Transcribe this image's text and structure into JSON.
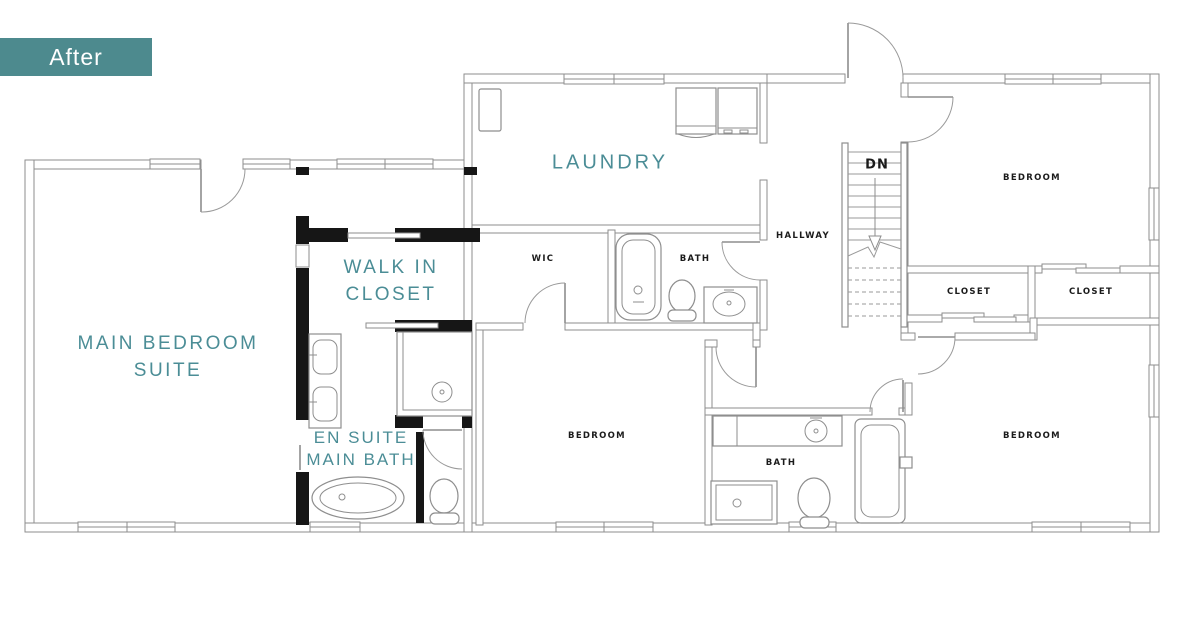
{
  "badge": {
    "label": "After"
  },
  "colors": {
    "badge_bg": "#4d8a8e",
    "teal_label": "#4b8d96",
    "black_label": "#1b1b1b",
    "existing_wall": "#8e8e8e",
    "new_wall": "#161616"
  },
  "rooms": {
    "main_suite": {
      "line1": "MAIN BEDROOM",
      "line2": "SUITE"
    },
    "walk_in": {
      "line1": "WALK IN",
      "line2": "CLOSET"
    },
    "ensuite": {
      "line1": "EN SUITE",
      "line2": "MAIN BATH"
    },
    "laundry": {
      "label": "LAUNDRY"
    },
    "wic": {
      "label": "WIC"
    },
    "bath_top": {
      "label": "BATH"
    },
    "hallway": {
      "label": "HALLWAY"
    },
    "bedroom_top_right": {
      "label": "BEDROOM"
    },
    "closet_left": {
      "label": "CLOSET"
    },
    "closet_right": {
      "label": "CLOSET"
    },
    "bedroom_bottom_middle": {
      "label": "BEDROOM"
    },
    "bedroom_bottom_right": {
      "label": "BEDROOM"
    },
    "bath_bottom": {
      "label": "BATH"
    }
  },
  "stairs": {
    "direction_label": "DN"
  },
  "fixtures": [
    "washer",
    "dryer",
    "tall-cabinet",
    "bathtub-top-bath",
    "toilet-top-bath",
    "vanity-top-bath",
    "double-vanity-ensuite",
    "walk-in-shower-ensuite",
    "freestanding-tub",
    "toilet-ensuite",
    "vanity-bottom-bath",
    "toilet-bottom-bath",
    "bathtub-bottom-bath",
    "shower-bottom-bath",
    "staircase"
  ]
}
